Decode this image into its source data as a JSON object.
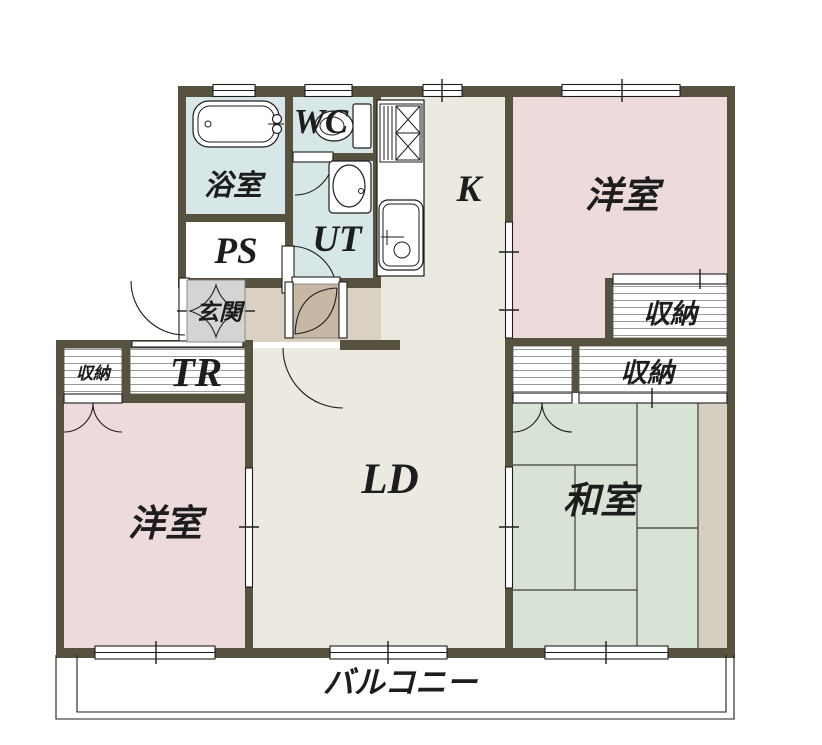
{
  "title": "apartment-floor-plan",
  "rooms": {
    "bath": {
      "label": "浴室"
    },
    "wc": {
      "label": "WC"
    },
    "ut": {
      "label": "UT"
    },
    "ps": {
      "label": "PS"
    },
    "kitchen": {
      "label": "K"
    },
    "living_dining": {
      "label": "LD"
    },
    "bedroom_right": {
      "label": "洋室"
    },
    "bedroom_left": {
      "label": "洋室"
    },
    "japanese_room": {
      "label": "和室"
    },
    "storage_right_upper": {
      "label": "収納"
    },
    "storage_right_lower": {
      "label": "収納"
    },
    "storage_left": {
      "label": "収納"
    },
    "trunk_room": {
      "label": "TR"
    },
    "entrance": {
      "label": "玄関"
    },
    "balcony": {
      "label": "バルコニー"
    }
  },
  "colors": {
    "wall": "#57523f",
    "water": "#d7e7e8",
    "floor": "#ece9e0",
    "hall": "#dbd1c2",
    "pink": "#ecdbda",
    "tatami": "#d9e3d5",
    "genkan": "#d4d4d4",
    "wood": "#c6b8a4",
    "strip": "#d6cec1",
    "white": "#ffffff"
  }
}
